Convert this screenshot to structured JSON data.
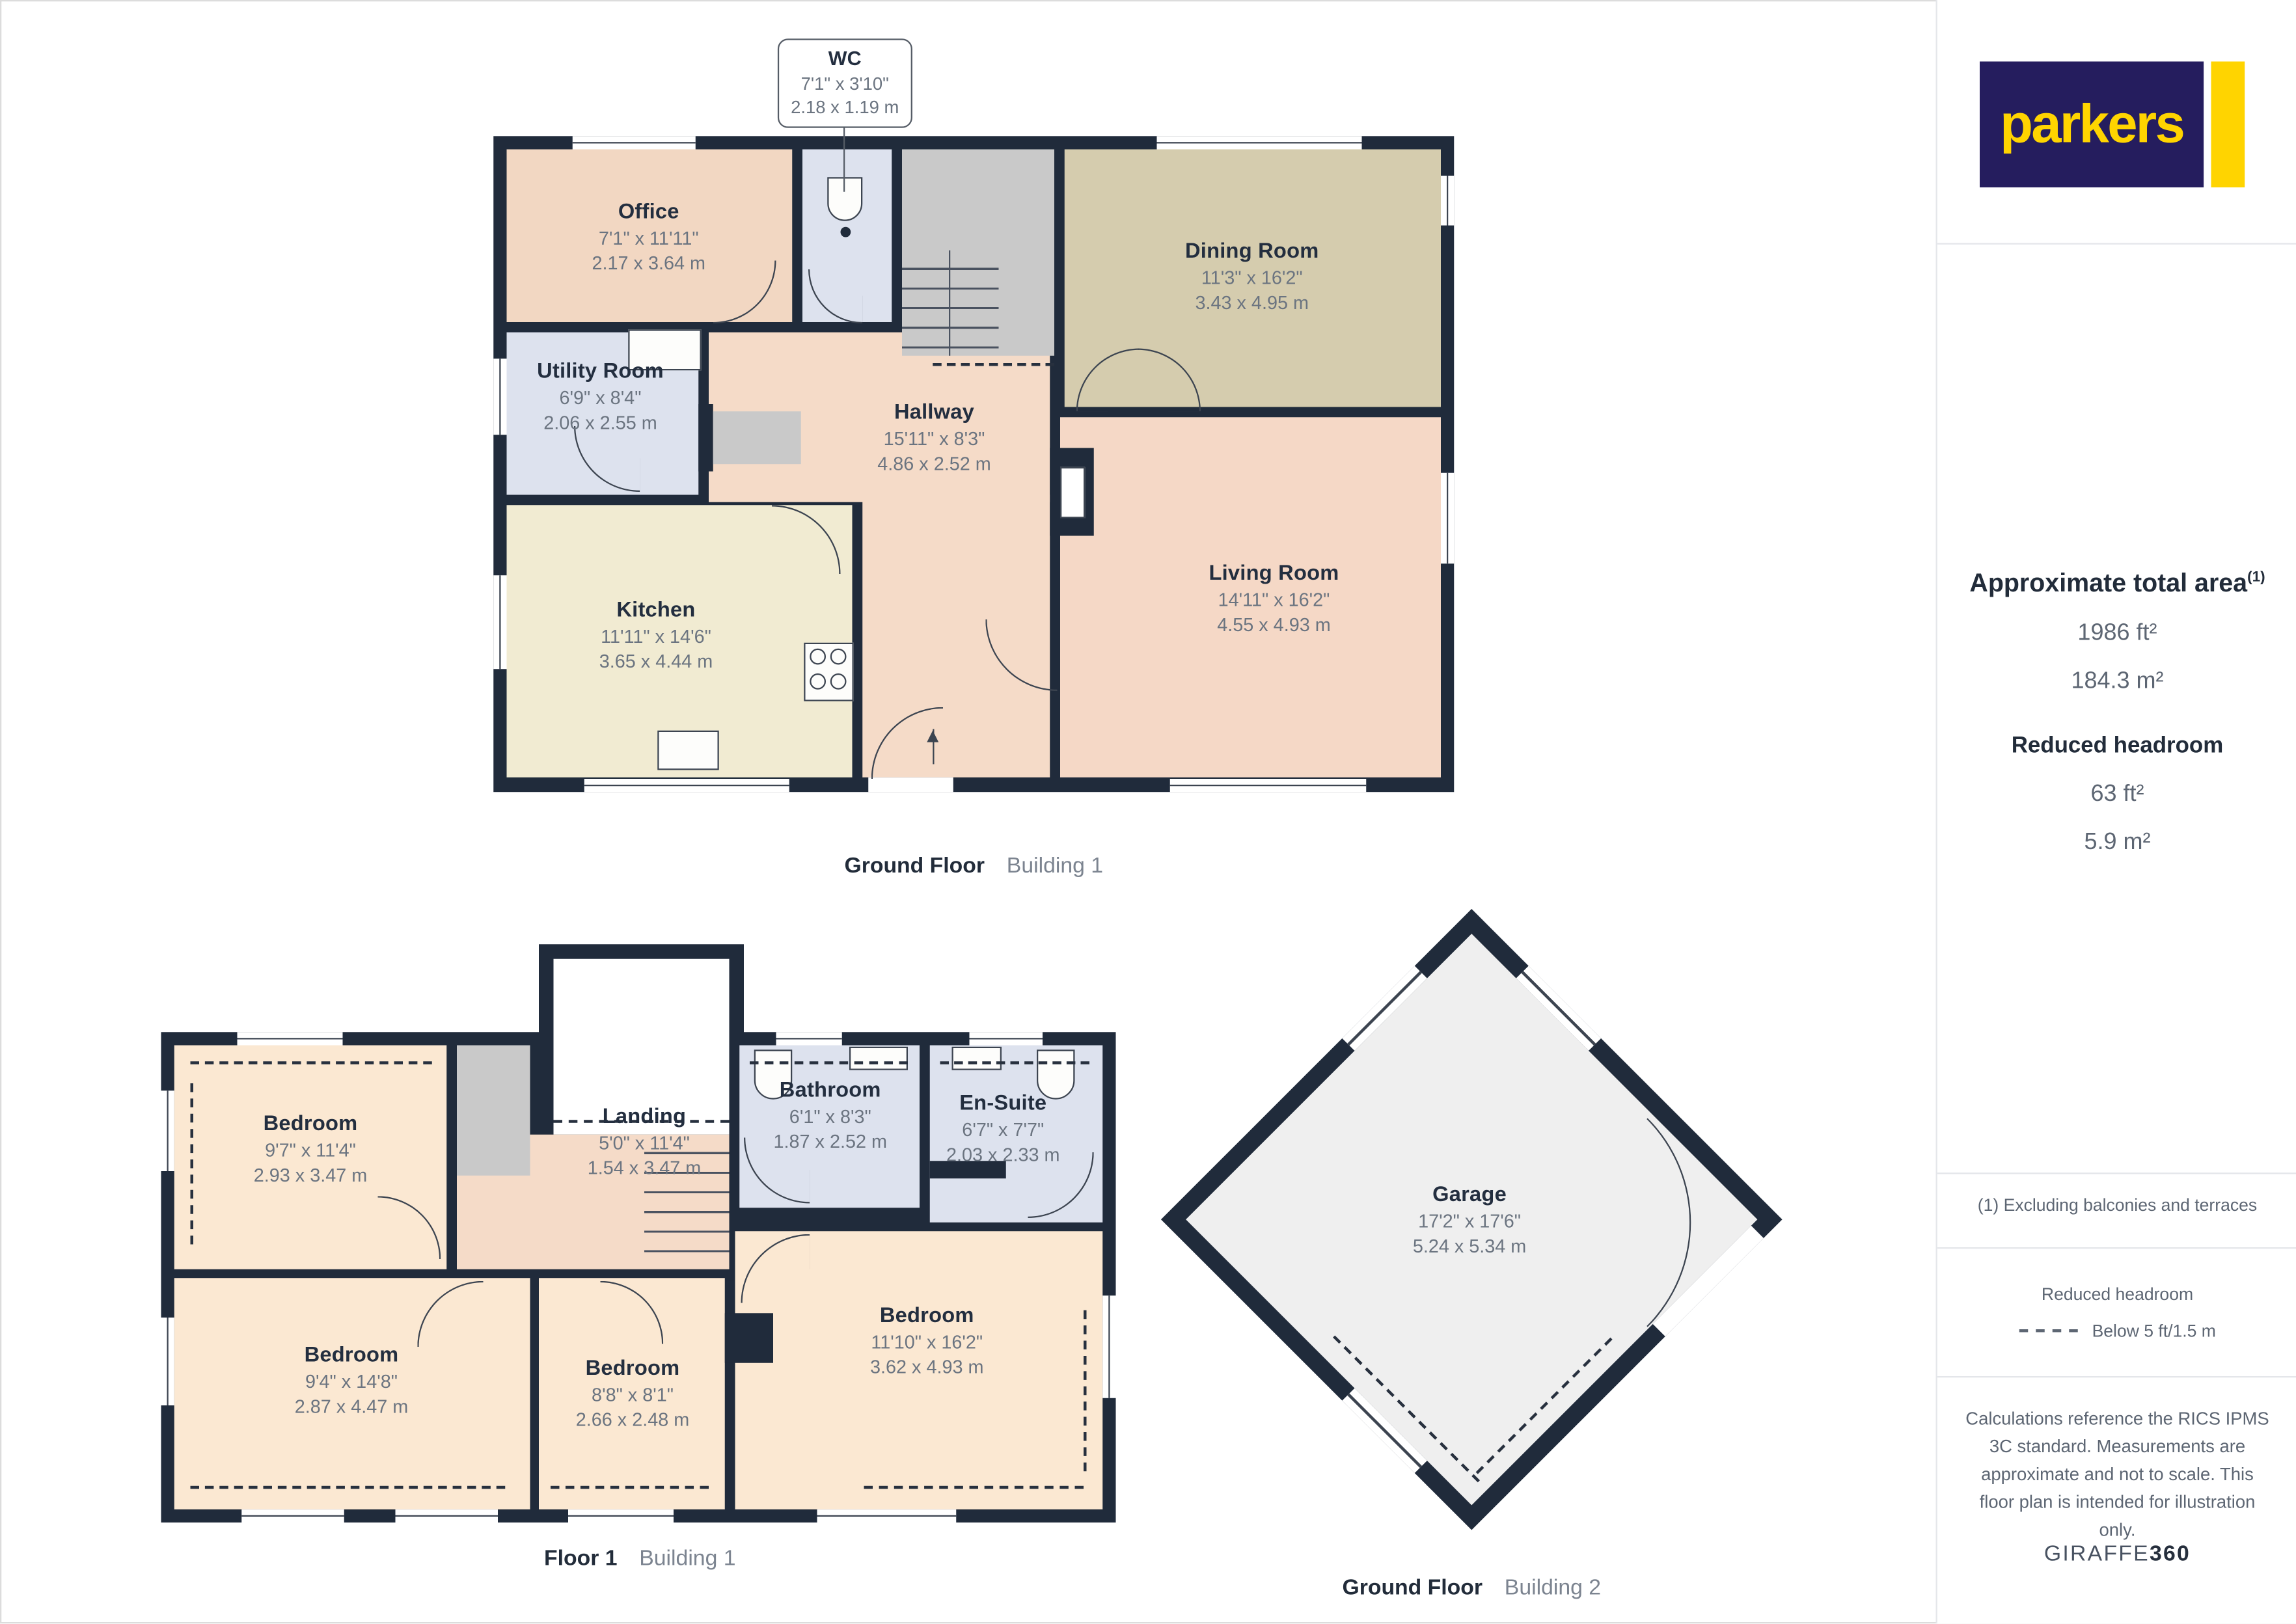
{
  "brand": {
    "logo_text": "parkers",
    "colors": {
      "brand_navy": "#251d5e",
      "brand_yellow": "#ffd400",
      "wall": "#202b3b"
    }
  },
  "callout": {
    "name": "WC",
    "dims_ft": "7'1\" x 3'10\"",
    "dims_m": "2.18 x 1.19 m"
  },
  "rooms": {
    "office": {
      "name": "Office",
      "dims_ft": "7'1\" x 11'11\"",
      "dims_m": "2.17 x 3.64 m"
    },
    "dining": {
      "name": "Dining Room",
      "dims_ft": "11'3\" x 16'2\"",
      "dims_m": "3.43 x 4.95 m"
    },
    "utility": {
      "name": "Utility Room",
      "dims_ft": "6'9\" x 8'4\"",
      "dims_m": "2.06 x 2.55 m"
    },
    "hallway": {
      "name": "Hallway",
      "dims_ft": "15'11\" x 8'3\"",
      "dims_m": "4.86 x 2.52 m"
    },
    "kitchen": {
      "name": "Kitchen",
      "dims_ft": "11'11\" x 14'6\"",
      "dims_m": "3.65 x 4.44 m"
    },
    "living": {
      "name": "Living Room",
      "dims_ft": "14'11\" x 16'2\"",
      "dims_m": "4.55 x 4.93 m"
    },
    "bedroom_tl": {
      "name": "Bedroom",
      "dims_ft": "9'7\" x 11'4\"",
      "dims_m": "2.93 x 3.47 m"
    },
    "landing": {
      "name": "Landing",
      "dims_ft": "5'0\" x 11'4\"",
      "dims_m": "1.54 x 3.47 m"
    },
    "bathroom": {
      "name": "Bathroom",
      "dims_ft": "6'1\" x 8'3\"",
      "dims_m": "1.87 x 2.52 m"
    },
    "ensuite": {
      "name": "En-Suite",
      "dims_ft": "6'7\" x 7'7\"",
      "dims_m": "2.03 x 2.33 m"
    },
    "bedroom_bl": {
      "name": "Bedroom",
      "dims_ft": "9'4\" x 14'8\"",
      "dims_m": "2.87 x 4.47 m"
    },
    "bedroom_bm": {
      "name": "Bedroom",
      "dims_ft": "8'8\" x 8'1\"",
      "dims_m": "2.66 x 2.48 m"
    },
    "bedroom_r": {
      "name": "Bedroom",
      "dims_ft": "11'10\" x 16'2\"",
      "dims_m": "3.62 x 4.93 m"
    },
    "garage": {
      "name": "Garage",
      "dims_ft": "17'2\" x 17'6\"",
      "dims_m": "5.24 x 5.34 m"
    }
  },
  "captions": {
    "gf1": {
      "floor": "Ground Floor",
      "building": "Building 1"
    },
    "f1": {
      "floor": "Floor 1",
      "building": "Building 1"
    },
    "gf2": {
      "floor": "Ground Floor",
      "building": "Building 2"
    }
  },
  "sidebar": {
    "total_area_title": "Approximate total area",
    "total_area_sup": "(1)",
    "total_area_ft": "1986 ft²",
    "total_area_m": "184.3 m²",
    "reduced_headroom_title": "Reduced headroom",
    "reduced_headroom_ft": "63 ft²",
    "reduced_headroom_m": "5.9 m²",
    "footnote": "(1) Excluding balconies and terraces",
    "legend_title": "Reduced headroom",
    "legend_label": "Below 5 ft/1.5 m",
    "disclaimer": "Calculations reference the RICS IPMS 3C standard. Measurements are approximate and not to scale. This floor plan is intended for illustration only.",
    "brand_footer_regular": "GIRAFFE",
    "brand_footer_bold": "360"
  }
}
